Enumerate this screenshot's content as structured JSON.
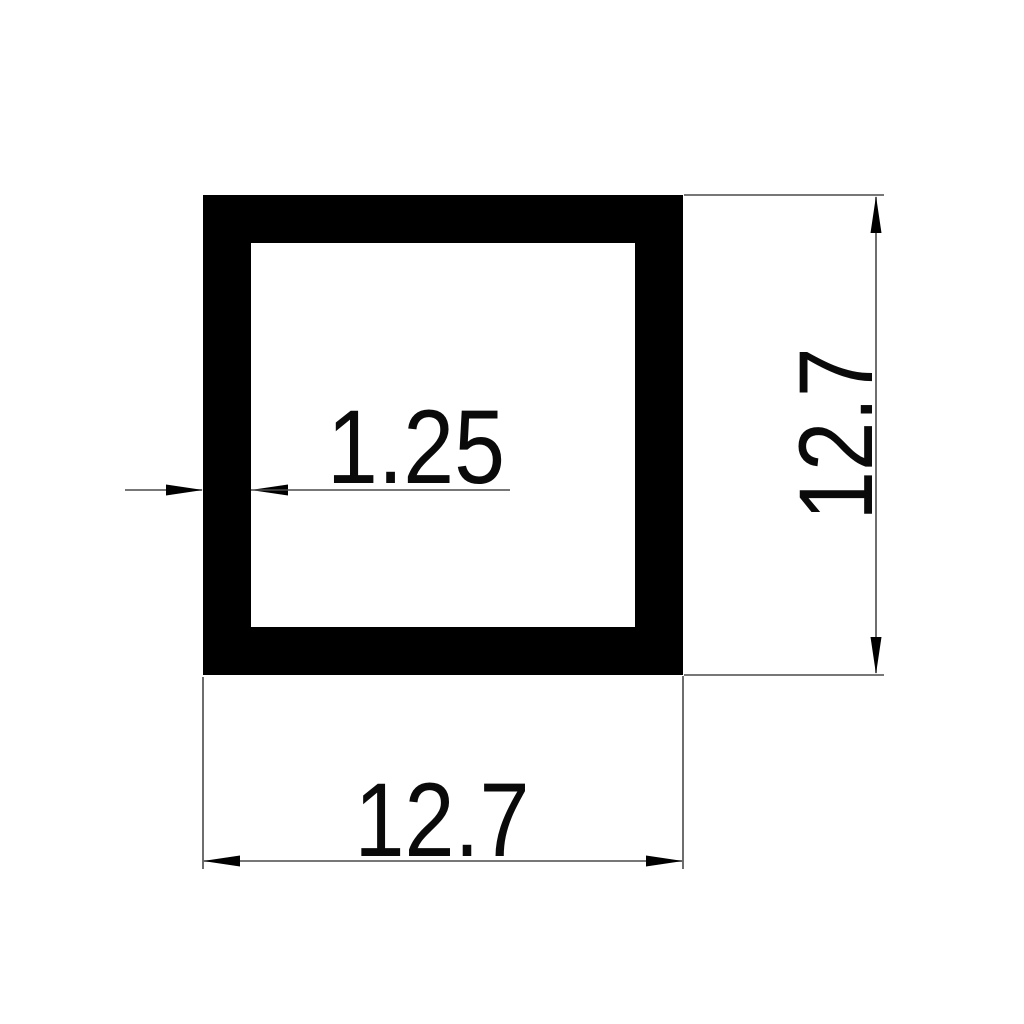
{
  "drawing": {
    "shape": "hollow-square-tube-cross-section",
    "labels": {
      "wall_thickness": "1.25",
      "outer_width": "12.7",
      "outer_height": "12.7"
    },
    "colors": {
      "ink": "#000000",
      "line": "#4a4a4a",
      "background": "#ffffff"
    }
  }
}
